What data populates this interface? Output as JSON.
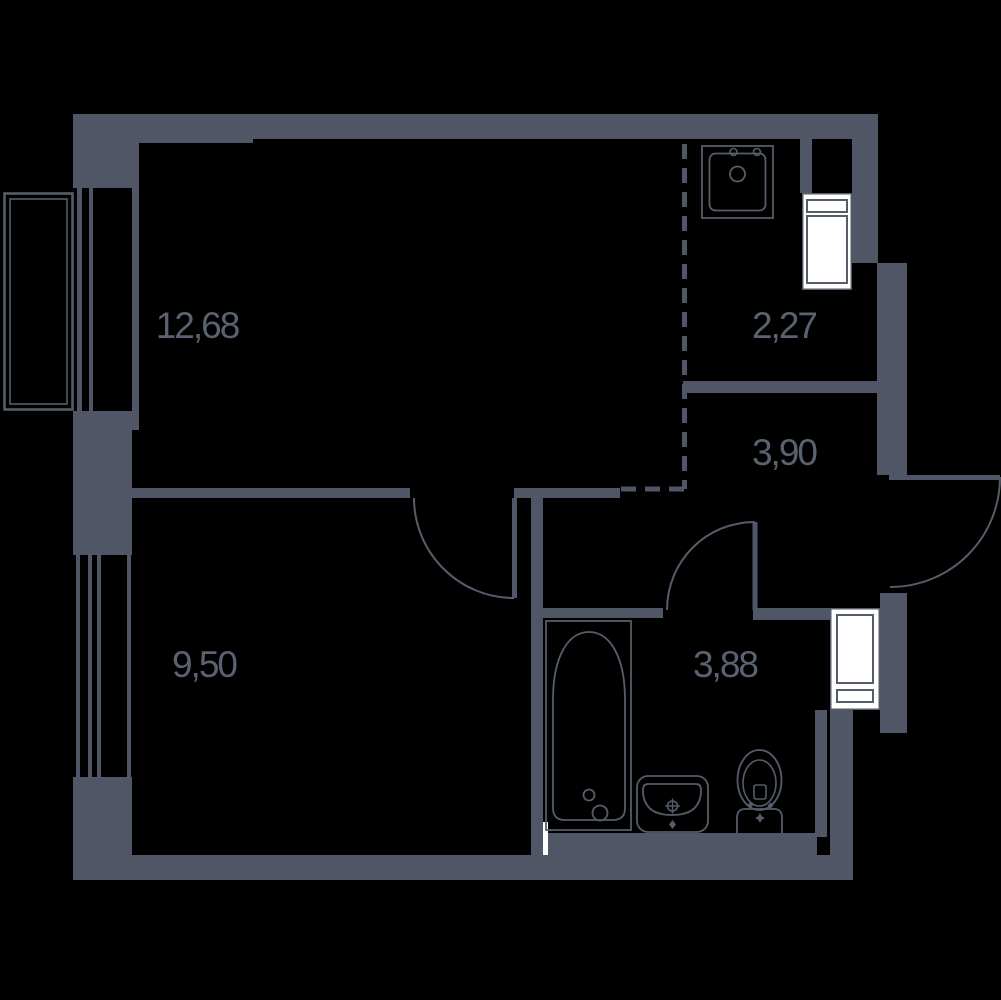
{
  "title": "Apartment floor plan",
  "colors": {
    "background": "#000000",
    "wall": "#505666",
    "line": "#565c6a",
    "label": "#5a6170",
    "white": "#ffffff"
  },
  "rooms": [
    {
      "name": "living-room",
      "area": "12,68"
    },
    {
      "name": "kitchen-niche",
      "area": "2,27"
    },
    {
      "name": "hallway",
      "area": "3,90"
    },
    {
      "name": "bedroom",
      "area": "9,50"
    },
    {
      "name": "bathroom",
      "area": "3,88"
    }
  ],
  "fixtures": [
    "loggia-window",
    "bedroom-window",
    "kitchen-sink",
    "appliance-cabinet-top",
    "appliance-cabinet-right",
    "bathtub",
    "washbasin",
    "toilet",
    "entrance-door",
    "living-room-door",
    "bathroom-door",
    "kitchen-zone-dashed-boundary"
  ]
}
